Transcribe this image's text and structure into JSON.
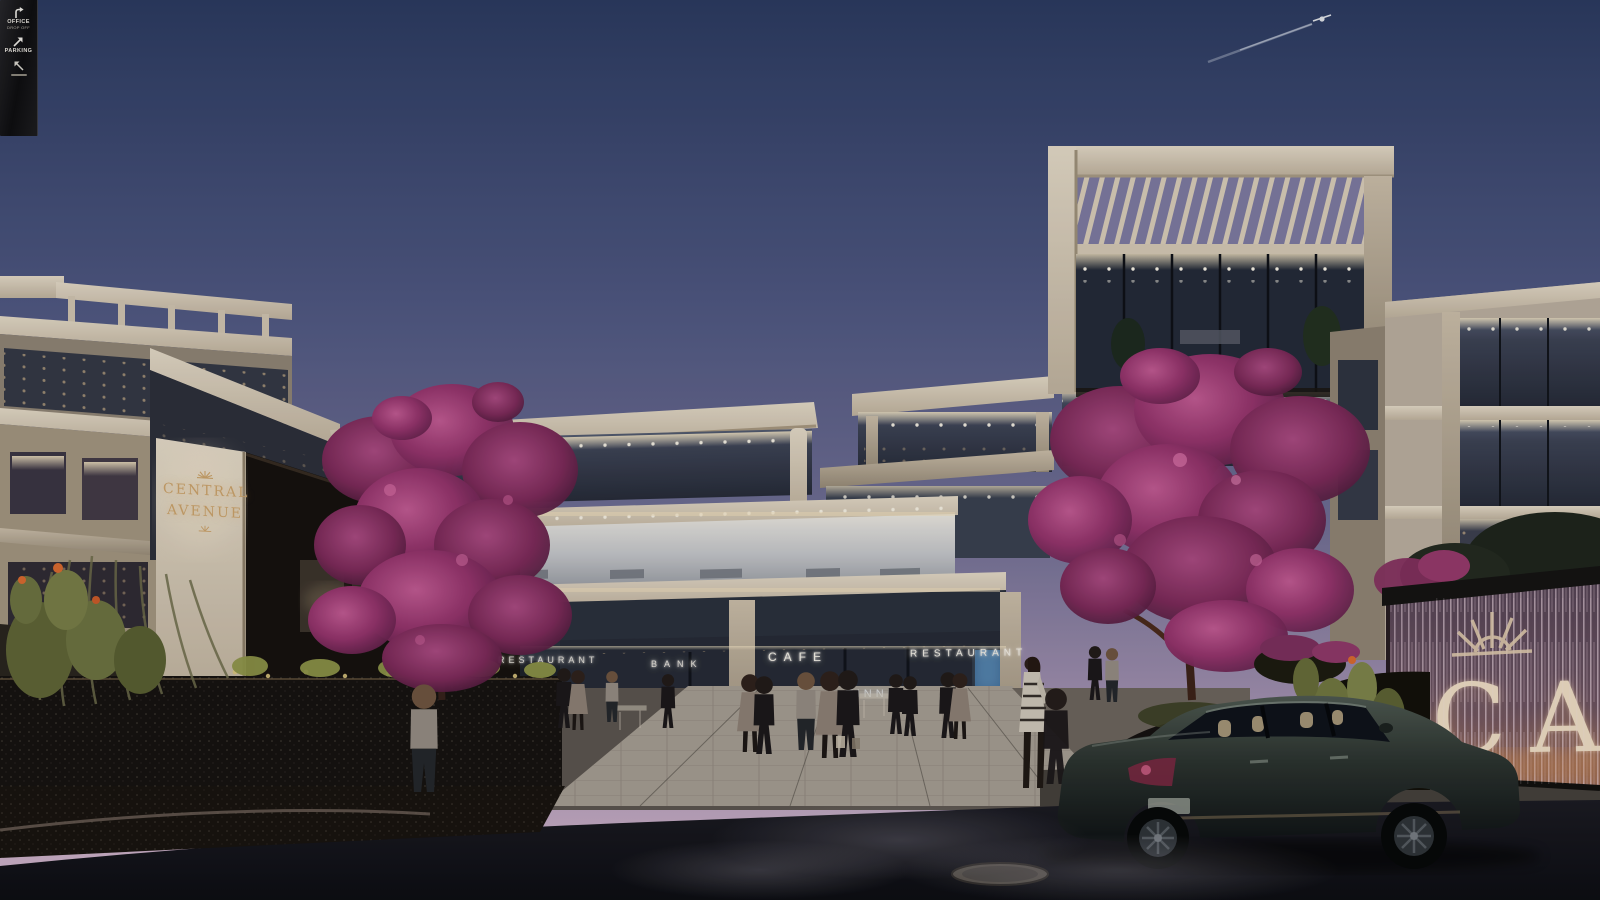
{
  "scene": {
    "name": "Central Avenue mixed-use development — dusk exterior rendering",
    "sky": {
      "top": "#2b3a60",
      "mid": "#4d5680",
      "lower": "#8079a0",
      "horizon": "#c9aec6"
    },
    "palette": {
      "facade_cream": "#d8cdbb",
      "brand_gold": "#c9a36c",
      "signage_white": "#f3efe6",
      "bougainvillea": "#a63a74",
      "warm_glow": "#f0dcb4",
      "asphalt": "#121318",
      "car_green": "#39423c"
    }
  },
  "signs": {
    "brand_wall": {
      "line1": "CENTRAL",
      "line2": "AVENUE"
    },
    "storefront_restaurant_left": "RESTAURANT",
    "storefront_bank": "BANK",
    "storefront_cafe": "CAFE",
    "storefront_restaurant_right": "RESTAURANT",
    "interior_neon": "TINNI",
    "monument_letters": "CA"
  },
  "wayfinding": {
    "item1_label": "OFFICE",
    "item1_sublabel": "DROP OFF",
    "item2_label": "PARKING",
    "item3_label": ""
  }
}
